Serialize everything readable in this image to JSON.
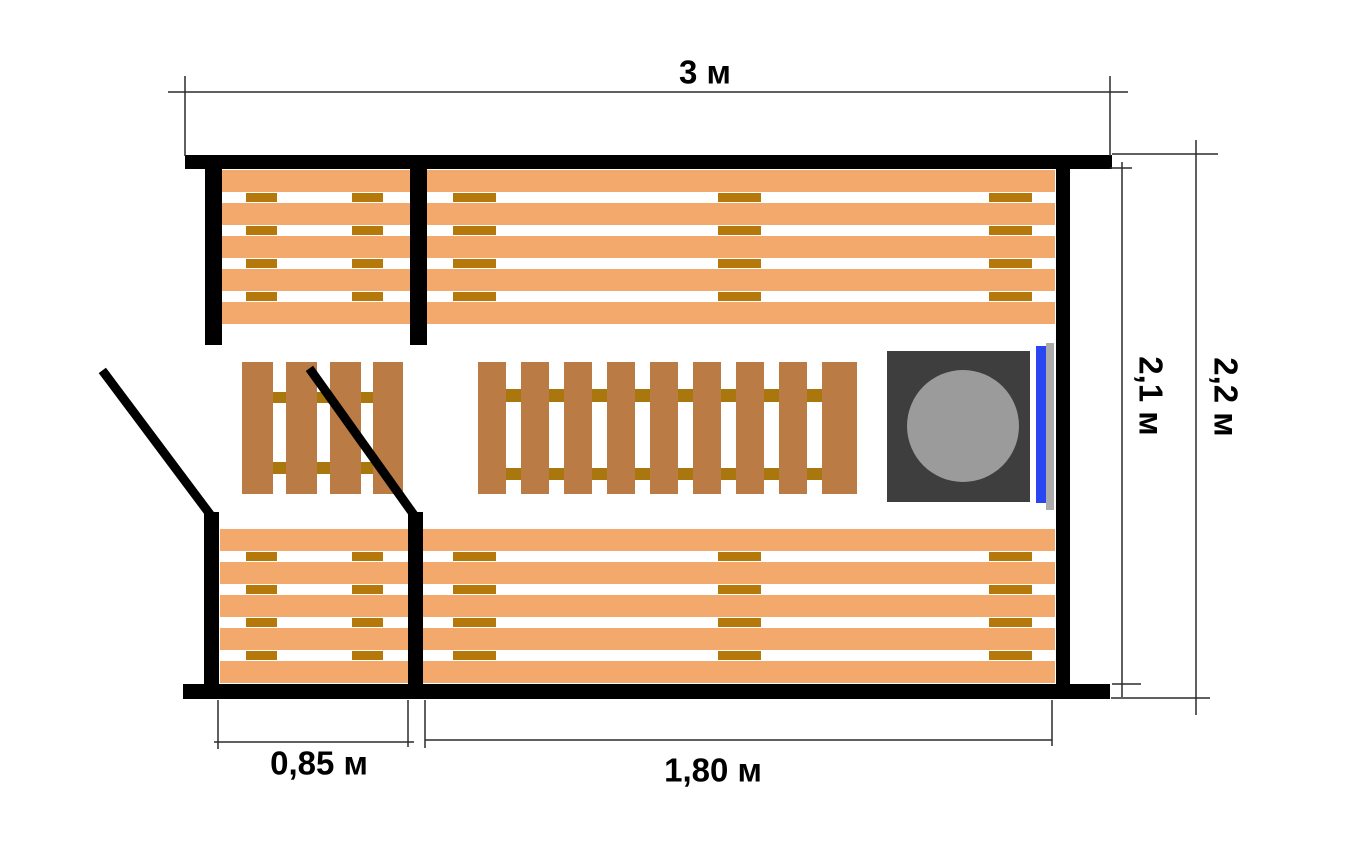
{
  "labels": {
    "width_top": "3 м",
    "height_inner": "2,1 м",
    "height_outer": "2,2 м",
    "door_section": "0,85 м",
    "bench_section": "1,80 м"
  },
  "colors": {
    "background": "#ffffff",
    "wall": "#000000",
    "bench_plank": "#F2A96B",
    "bench_spacer": "#B5790B",
    "duckboard_slat": "#BA7B45",
    "duckboard_rail": "#A9770E",
    "stove_body": "#3E3E3E",
    "stove_plate": "#9B9B9B",
    "stove_glass": "#2946F0",
    "stove_vent": "#ABABAB",
    "door_line": "#000000",
    "dimension_line": "#2B2B2B"
  },
  "plan": {
    "walls": [
      {
        "name": "wall-top",
        "x": 185,
        "y": 155,
        "w": 927,
        "h": 14
      },
      {
        "name": "wall-bottom",
        "x": 183,
        "y": 684,
        "w": 927,
        "h": 15
      },
      {
        "name": "wall-right",
        "x": 1056,
        "y": 160,
        "w": 14,
        "h": 530
      },
      {
        "name": "wall-left-upper",
        "x": 205,
        "y": 168,
        "w": 17,
        "h": 177
      },
      {
        "name": "wall-left-lower",
        "x": 204,
        "y": 512,
        "w": 15,
        "h": 172
      },
      {
        "name": "wall-partition-upper",
        "x": 410,
        "y": 168,
        "w": 17,
        "h": 177
      },
      {
        "name": "wall-partition-lower",
        "x": 408,
        "y": 512,
        "w": 15,
        "h": 172
      }
    ],
    "benches": [
      {
        "name": "bench-top-left",
        "x": 222,
        "y": 170,
        "w": 188,
        "planks": 5,
        "plank_h": 22,
        "gap_h": 11,
        "spacer_w": 31,
        "spacer_xs": [
          246,
          352
        ]
      },
      {
        "name": "bench-top-main",
        "x": 427,
        "y": 170,
        "w": 628,
        "planks": 5,
        "plank_h": 22,
        "gap_h": 11,
        "spacer_w": 43,
        "spacer_xs": [
          453,
          718,
          989
        ]
      },
      {
        "name": "bench-bottom-left",
        "x": 220,
        "y": 529,
        "w": 188,
        "planks": 5,
        "plank_h": 22,
        "gap_h": 11,
        "spacer_w": 31,
        "spacer_xs": [
          246,
          352
        ]
      },
      {
        "name": "bench-bottom-main",
        "x": 423,
        "y": 529,
        "w": 632,
        "planks": 5,
        "plank_h": 22,
        "gap_h": 11,
        "spacer_w": 43,
        "spacer_xs": [
          453,
          718,
          989
        ]
      }
    ],
    "duckboards": [
      {
        "name": "duckboard-small",
        "y": 362,
        "h": 132,
        "rails": [
          {
            "y": 392,
            "h": 11
          },
          {
            "y": 462,
            "h": 12
          }
        ],
        "slats": [
          {
            "x": 242,
            "w": 31
          },
          {
            "x": 286,
            "w": 31
          },
          {
            "x": 330,
            "w": 31
          },
          {
            "x": 373,
            "w": 30
          }
        ]
      },
      {
        "name": "duckboard-large",
        "y": 362,
        "h": 132,
        "rails": [
          {
            "y": 389,
            "h": 13
          },
          {
            "y": 468,
            "h": 12
          }
        ],
        "slats": [
          {
            "x": 478,
            "w": 28
          },
          {
            "x": 521,
            "w": 28
          },
          {
            "x": 564,
            "w": 28
          },
          {
            "x": 607,
            "w": 28
          },
          {
            "x": 650,
            "w": 28
          },
          {
            "x": 693,
            "w": 28
          },
          {
            "x": 736,
            "w": 28
          },
          {
            "x": 779,
            "w": 28
          },
          {
            "x": 822,
            "w": 35
          }
        ]
      }
    ],
    "stove": {
      "body": {
        "x": 887,
        "y": 351,
        "w": 143,
        "h": 151
      },
      "plate": {
        "cx": 963,
        "cy": 426,
        "r": 56
      },
      "glass": {
        "x": 1036,
        "y": 346,
        "w": 10,
        "h": 157
      },
      "vent": {
        "x": 1046,
        "y": 343,
        "w": 8,
        "h": 167
      }
    },
    "doors": [
      {
        "name": "door-swing-entrance",
        "x1": 105,
        "y1": 374,
        "x2": 209,
        "y2": 513,
        "stroke_w": 9
      },
      {
        "name": "door-swing-partition",
        "x1": 312,
        "y1": 372,
        "x2": 414,
        "y2": 515,
        "stroke_w": 9
      }
    ],
    "dimensions": [
      {
        "name": "dim-width-top",
        "segments": [
          [
            168,
            92,
            1128,
            92
          ],
          [
            185,
            76,
            185,
            156
          ],
          [
            1110,
            76,
            1110,
            156
          ]
        ]
      },
      {
        "name": "dim-height-inner",
        "segments": [
          [
            1122,
            162,
            1122,
            697
          ],
          [
            1110,
            168,
            1132,
            168
          ],
          [
            1112,
            684,
            1141,
            684
          ]
        ]
      },
      {
        "name": "dim-height-outer",
        "segments": [
          [
            1196,
            140,
            1196,
            715
          ],
          [
            1112,
            154,
            1218,
            154
          ],
          [
            1111,
            698,
            1210,
            698
          ]
        ]
      },
      {
        "name": "dim-door-section",
        "segments": [
          [
            214,
            742,
            414,
            742
          ],
          [
            218,
            700,
            218,
            749
          ],
          [
            408,
            700,
            408,
            747
          ]
        ]
      },
      {
        "name": "dim-bench-section",
        "segments": [
          [
            425,
            740,
            1052,
            740
          ],
          [
            425,
            700,
            425,
            748
          ],
          [
            1052,
            700,
            1052,
            746
          ]
        ]
      }
    ]
  }
}
